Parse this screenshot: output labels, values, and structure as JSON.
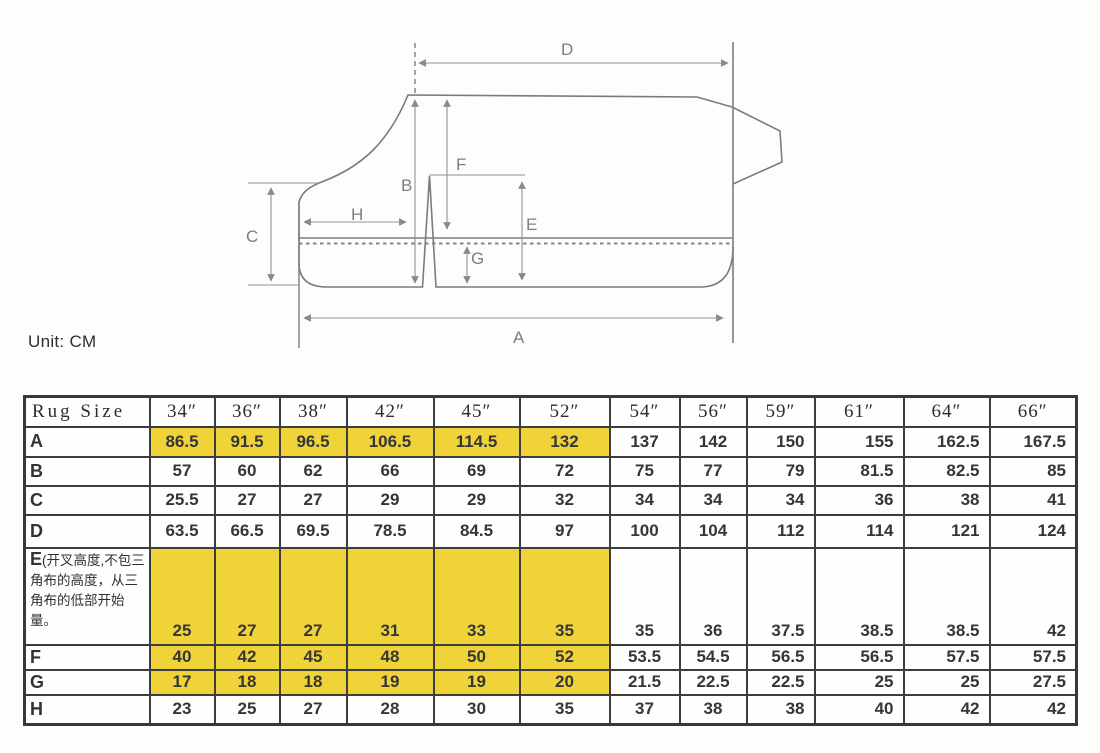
{
  "unit_label": "Unit: CM",
  "diagram": {
    "description": "rug pattern outline with dimension arrows",
    "labels": {
      "a": "A",
      "b": "B",
      "c": "C",
      "d": "D",
      "e": "E",
      "f": "F",
      "g": "G",
      "h": "H"
    }
  },
  "table": {
    "header": [
      "Rug Size",
      "34″",
      "36″",
      "38″",
      "42″",
      "45″",
      "52″",
      "54″",
      "56″",
      "59″",
      "61″",
      "64″",
      "66″"
    ],
    "rows": [
      {
        "label": "A",
        "values": [
          "86.5",
          "91.5",
          "96.5",
          "106.5",
          "114.5",
          "132",
          "137",
          "142",
          "150",
          "155",
          "162.5",
          "167.5"
        ],
        "highlight_first_n": 6
      },
      {
        "label": "B",
        "values": [
          "57",
          "60",
          "62",
          "66",
          "69",
          "72",
          "75",
          "77",
          "79",
          "81.5",
          "82.5",
          "85"
        ],
        "highlight_first_n": 0
      },
      {
        "label": "C",
        "values": [
          "25.5",
          "27",
          "27",
          "29",
          "29",
          "32",
          "34",
          "34",
          "34",
          "36",
          "38",
          "41"
        ],
        "highlight_first_n": 0
      },
      {
        "label": "D",
        "values": [
          "63.5",
          "66.5",
          "69.5",
          "78.5",
          "84.5",
          "97",
          "100",
          "104",
          "112",
          "114",
          "121",
          "124"
        ],
        "highlight_first_n": 0
      },
      {
        "label": "E",
        "label_note": "(开叉高度,不包三角布的高度，从三角布的低部开始量。",
        "values": [
          "25",
          "27",
          "27",
          "31",
          "33",
          "35",
          "35",
          "36",
          "37.5",
          "38.5",
          "38.5",
          "42"
        ],
        "highlight_first_n": 6,
        "tall": true
      },
      {
        "label": "F",
        "values": [
          "40",
          "42",
          "45",
          "48",
          "50",
          "52",
          "53.5",
          "54.5",
          "56.5",
          "56.5",
          "57.5",
          "57.5"
        ],
        "highlight_first_n": 6
      },
      {
        "label": "G",
        "values": [
          "17",
          "18",
          "18",
          "19",
          "19",
          "20",
          "21.5",
          "22.5",
          "22.5",
          "25",
          "25",
          "27.5"
        ],
        "highlight_first_n": 6
      },
      {
        "label": "H",
        "values": [
          "23",
          "25",
          "27",
          "28",
          "30",
          "35",
          "37",
          "38",
          "38",
          "40",
          "42",
          "42"
        ],
        "highlight_first_n": 0
      }
    ]
  },
  "colors": {
    "highlight_yellow": "#F0D338",
    "table_border": "#3d3d3d",
    "diagram_line": "#8f8f8f",
    "text": "#363636"
  }
}
